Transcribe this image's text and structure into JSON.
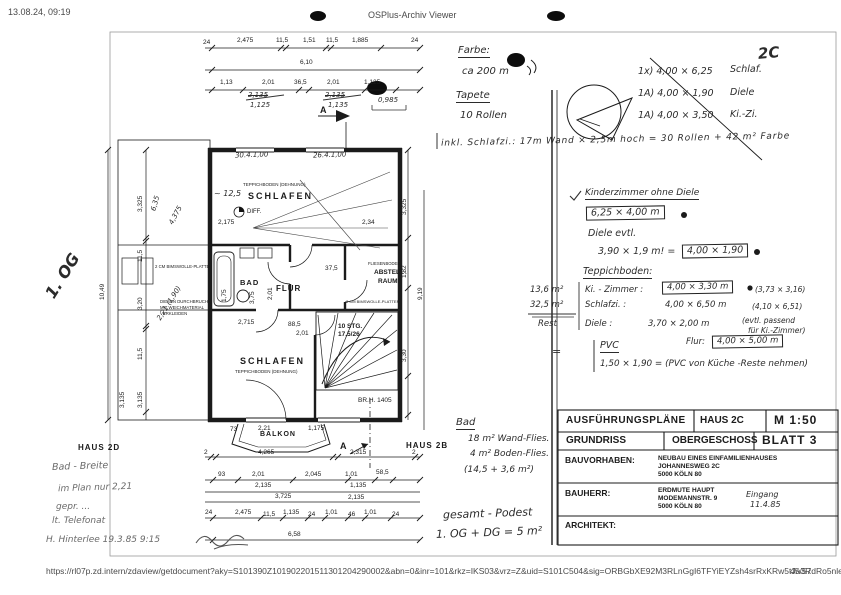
{
  "header": {
    "timestamp": "13.08.24, 09:19",
    "viewer_title": "OSPlus-Archiv Viewer"
  },
  "footer": {
    "url": "https://rl07p.zd.intern/zdaview/getdocument?aky=S101390Z101902201511301204290002&abn=0&inr=101&rkz=IKS03&vrz=Z&uid=S101C504&sig=ORBGbXE92M3RLnGgI6TFYiEYZsh4srRxKRw5tJa3RdRo5nle...",
    "page_indicator": "45/57"
  },
  "colors": {
    "ink": "#1b1b1b",
    "paper": "#ffffff",
    "chrome_text": "#4a4a4a"
  },
  "plan": {
    "rooms": {
      "teppich_top": "TEPPICHBODEN (DEHNUNG)",
      "schlafen_top": "SCHLAFEN",
      "diff": "DIFF.",
      "bad": "BAD",
      "flur": "FLUR",
      "abstell1": "ABSTELL-",
      "abstell2": "RAUM",
      "fliesen": "FLIESENBODEN",
      "stg1": "10 STG.",
      "stg2": "17,5/26",
      "schlafen_bot": "SCHLAFEN",
      "teppich_bot": "TEPPICHBODEN (DEHNUNG)",
      "balkon": "BALKON",
      "brh": "BR.H. 1405",
      "haus_l": "HAUS 2D",
      "haus_r": "HAUS 2B",
      "a_top": "A",
      "a_bot": "A",
      "duct1": "DIESEN DURCHBRUCH",
      "duct2": "MIT WEICHMATERIAL",
      "duct3": "VERKLEIDEN",
      "bims1": "2 CM BIMSWOLLE-PLATTE",
      "bims2": "2 CM BIMSWOLLE-PLATTEN"
    },
    "dims": {
      "t1l": "24",
      "t1a": "2,475",
      "t1b": "11,5",
      "t1c": "1,51",
      "t1d": "11,5",
      "t1e": "1,885",
      "t1r": "24",
      "t2": "6,10",
      "t3a": "1,13",
      "t3b": "2,01",
      "t3c": "36,5",
      "t3d": "2,01",
      "t3e": "1,125",
      "th1": "2,135",
      "th2": "1,125",
      "th3": "2,135",
      "th4": "1,135",
      "th5": "0,985",
      "l_total": "10,49",
      "l1": "3,325",
      "l2": "11,5",
      "l3": "3,20",
      "l4": "11,5",
      "l5": "3,135",
      "l6": "3,135",
      "r1": "3,325",
      "r2": "1,82",
      "r3": "9,19",
      "r4": "3,30",
      "i1": "2,175",
      "i2": "2,34",
      "i3": "2,01",
      "i4": "3,75",
      "i5": "1,75",
      "i6": "37,5",
      "i7": "2,715",
      "i8": "88,5",
      "i9": "2,01",
      "b0a": "73",
      "b0b": "2,21",
      "b0c": "1,175",
      "b1l": "2",
      "b1a": "4,265",
      "b1b": "2,315",
      "b1r": "2",
      "b2a": "93",
      "b2b": "2,01",
      "b2c": "2,045",
      "b2d": "1,01",
      "b2e": "58,5",
      "b3a": "2,135",
      "b3b": "1,135",
      "b4a": "3,725",
      "b4b": "2,135",
      "b5a": "24",
      "b5b": "2,475",
      "b5c": "11,5",
      "b5d": "1,135",
      "b5e": "24",
      "b5f": "1,01",
      "b5g": "46",
      "b5h": "1,01",
      "b5i": "24",
      "b6": "6,58"
    }
  },
  "hand": {
    "corner": "2C",
    "farbe": "Farbe:",
    "farbe_qty": "ca 200 m",
    "tapete": "Tapete",
    "tapete_qty": "10 Rollen",
    "list1": "1x) 4,00 × 6,25",
    "list1_room": "Schlaf.",
    "list2": "1A) 4,00 × 1,90",
    "list2_room": "Diele",
    "list3": "1A) 4,00 × 3,50",
    "list3_room": "Ki.-Zi.",
    "wall_calc": "inkl. Schlafzi.: 17m Wand × 2,5m hoch = 30 Rollen + 42 m² Farbe",
    "kizi_ohne": "Kinderzimmer ohne Diele",
    "kizi_box": "6,25 × 4,00 m",
    "diele_evtl": "Diele evtl.",
    "diele_calc": "3,90 × 1,9 m! =",
    "diele_box": "4,00 × 1,90",
    "teppich_hdr": "Teppichboden:",
    "t_r1_area": "13,6 m²",
    "t_r1_room": "Ki. - Zimmer :",
    "t_r1_box": "4,00 × 3,30 m",
    "t_r1_note": "(3,73 × 3,16)",
    "t_r2_area": "32,5 m²",
    "t_r2_room": "Schlafzi. :",
    "t_r2_val": "4,00 × 6,50 m",
    "t_r2_note": "(4,10 × 6,51)",
    "t_r3_area": "Rest",
    "t_r3_room": "Diele :",
    "t_r3_val": "3,70 × 2,00 m",
    "t_r3_note1": "(evtl. passend",
    "t_r3_note2": "für Ki.-Zimmer)",
    "pvc_eq": "=",
    "pvc": "PVC",
    "flur_lbl": "Flur:",
    "flur_box": "4,00 × 5,00 m",
    "pvc_calc": "1,50 × 1,90  =  (PVC von Küche -Reste nehmen)",
    "bad_hdr": "Bad",
    "bad1": "18 m² Wand-Flies.",
    "bad2": "4 m² Boden-Flies.",
    "bad3": "(14,5 + 3,6 m²)",
    "podest1": "gesamt - Podest",
    "podest2": "1. OG + DG = 5 m²",
    "og_big": "1. OG",
    "l_hand1": "6,35",
    "l_hand2": "4,375",
    "l_hand3": "2,21 (1,90)",
    "win1": "30.4.1,00",
    "win2": "26.4.1,00",
    "qm": "~ 12,5",
    "note1": "Bad - Breite",
    "note2": "im Plan nur 2,21",
    "note3": "gepr. ...",
    "note4": "lt. Telefonat",
    "note5": "H. Hinterlee 19.3.85  9:15",
    "eingang1": "Eingang",
    "eingang2": "11.4.85"
  },
  "titleblock": {
    "r1c1": "AUSFÜHRUNGSPLÄNE",
    "r1c2": "HAUS 2C",
    "r1c3": "M 1:50",
    "r2c1": "GRUNDRISS",
    "r2c2": "OBERGESCHOSS",
    "r2c3": "BLATT 3",
    "r3l": "BAUVORHABEN:",
    "r3v1": "NEUBAU EINES EINFAMILIENHAUSES",
    "r3v2": "JOHANNESWEG 2C",
    "r3v3": "5000 KÖLN 80",
    "r4l": "BAUHERR:",
    "r4v1": "ERDMUTE HAUPT",
    "r4v2": "MODEMANNSTR. 9",
    "r4v3": "5000 KÖLN 80",
    "r5l": "ARCHITEKT:"
  }
}
